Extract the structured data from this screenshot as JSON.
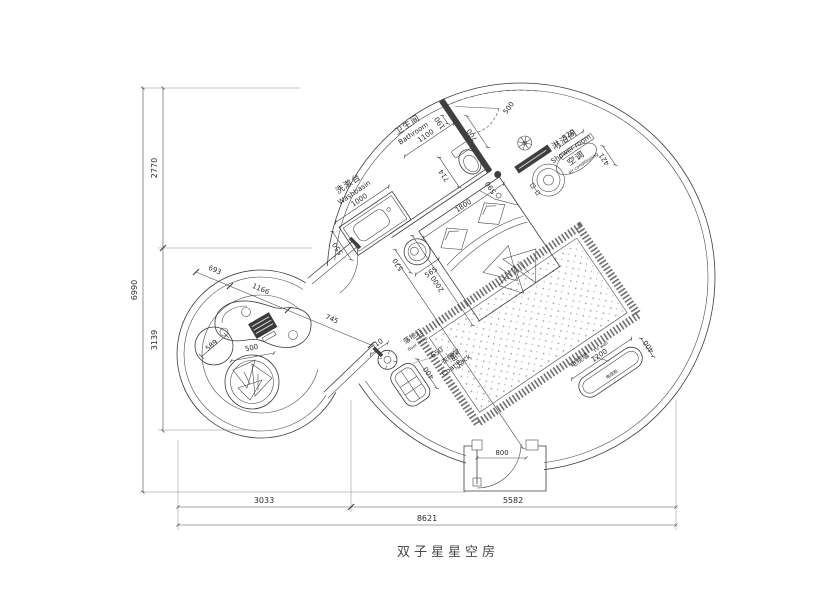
{
  "title": "双子星星空房",
  "labels": {
    "washbasin_cn": "洗漱台",
    "washbasin_en": "Washbasin",
    "bathroom_cn": "卫生间",
    "bathroom_en": "Bathroom",
    "shower_cn": "淋浴间",
    "shower_en": "Shower room",
    "ac_cn": "空调",
    "ac_en": "air conditioning",
    "lamp_cn": "落地灯",
    "lamp_en": "floor lamp",
    "coat_cn": "衣帽架",
    "coat_en": "Coat rack",
    "tv_cn": "电视墙",
    "tv_en": "TV wall",
    "tv_cabinet": "电视柜"
  },
  "dims": {
    "washbasin": "1000",
    "vanity_depth": "550",
    "toilet": "714",
    "bath_width": "1100",
    "wall_offset": "190",
    "bath_door": "700",
    "shower_door": "500",
    "drain": "590",
    "bed_width": "1800",
    "bed_length": "2000",
    "table_w": "565",
    "table_h": "570",
    "diag": "5684",
    "lamp": "310",
    "coat_len": "650",
    "coat_w": "400",
    "tv_len": "1200",
    "tv_w": "400",
    "door": "800",
    "ac_len": "520",
    "ac_w": "421",
    "lounge_a": "693",
    "lounge_b": "1166",
    "lounge_c": "745",
    "pouf": "589",
    "pod": "500",
    "left_top": "2770",
    "left_bottom": "3139",
    "left_total": "6990",
    "bottom_left": "3033",
    "bottom_right": "5582",
    "bottom_total": "8621"
  }
}
